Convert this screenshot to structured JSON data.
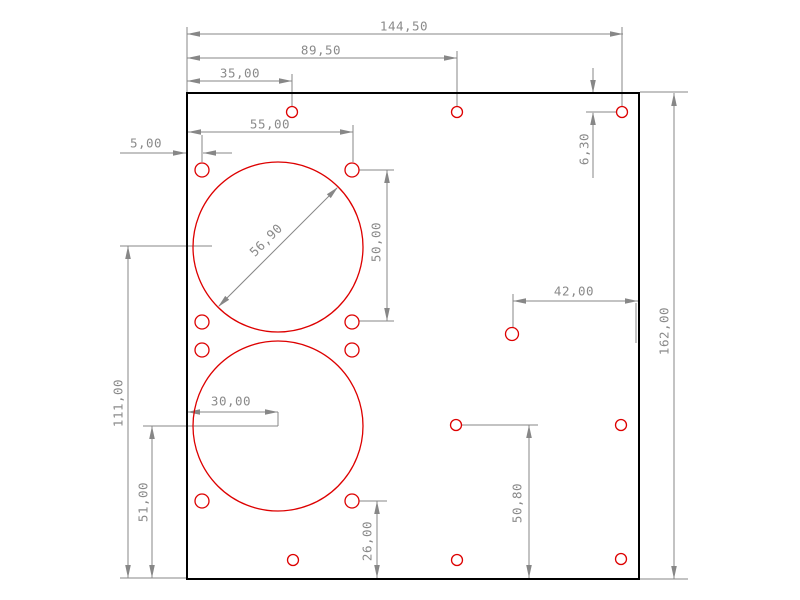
{
  "app": {
    "title": "CAD plate drawing"
  },
  "drawing": {
    "canvas": {
      "width": 800,
      "height": 600
    },
    "colors": {
      "background": "#ffffff",
      "outline": "#000000",
      "feature_red": "#dd0000",
      "dimension_line": "#878787",
      "dimension_text": "#8a8a8a"
    },
    "plate": {
      "x": 187,
      "y": 93,
      "width": 452,
      "height": 486
    },
    "cutouts": [
      {
        "cx": 278,
        "cy": 247,
        "r": 85
      },
      {
        "cx": 278,
        "cy": 426,
        "r": 85
      }
    ],
    "holes": [
      {
        "cx": 202,
        "cy": 170,
        "r": 7
      },
      {
        "cx": 352,
        "cy": 170,
        "r": 7
      },
      {
        "cx": 202,
        "cy": 322,
        "r": 7
      },
      {
        "cx": 352,
        "cy": 322,
        "r": 7
      },
      {
        "cx": 202,
        "cy": 350,
        "r": 7
      },
      {
        "cx": 352,
        "cy": 350,
        "r": 7
      },
      {
        "cx": 202,
        "cy": 501,
        "r": 7
      },
      {
        "cx": 352,
        "cy": 501,
        "r": 7
      },
      {
        "cx": 292,
        "cy": 112,
        "r": 5.5
      },
      {
        "cx": 457,
        "cy": 112,
        "r": 5.5
      },
      {
        "cx": 622,
        "cy": 112,
        "r": 5.5
      },
      {
        "cx": 512,
        "cy": 334,
        "r": 6.5
      },
      {
        "cx": 456,
        "cy": 425,
        "r": 5.5
      },
      {
        "cx": 621,
        "cy": 425,
        "r": 5.5
      },
      {
        "cx": 293,
        "cy": 560,
        "r": 5.5
      },
      {
        "cx": 457,
        "cy": 560,
        "r": 5.5
      },
      {
        "cx": 621,
        "cy": 559,
        "r": 5.5
      }
    ],
    "dimensions": [
      {
        "name": "dimension-144-50",
        "label": "144,50",
        "text": {
          "x": 404,
          "y": 26,
          "rot": 0
        },
        "lines": [
          [
            187,
            34,
            623,
            34
          ],
          [
            187,
            27,
            187,
            92
          ],
          [
            622,
            27,
            622,
            106
          ]
        ],
        "arrows": [
          {
            "tip": [
              187,
              34
            ],
            "dir": "left"
          },
          {
            "tip": [
              623,
              34
            ],
            "dir": "right"
          }
        ]
      },
      {
        "name": "dimension-89-50",
        "label": "89,50",
        "text": {
          "x": 321,
          "y": 50,
          "rot": 0
        },
        "lines": [
          [
            187,
            58,
            457,
            58
          ],
          [
            457,
            51,
            457,
            106
          ]
        ],
        "arrows": [
          {
            "tip": [
              187,
              58
            ],
            "dir": "left"
          },
          {
            "tip": [
              457,
              58
            ],
            "dir": "right"
          }
        ]
      },
      {
        "name": "dimension-35-00",
        "label": "35,00",
        "text": {
          "x": 240,
          "y": 73,
          "rot": 0
        },
        "lines": [
          [
            187,
            81,
            292,
            81
          ],
          [
            292,
            74,
            292,
            106
          ]
        ],
        "arrows": [
          {
            "tip": [
              187,
              81
            ],
            "dir": "left"
          },
          {
            "tip": [
              292,
              81
            ],
            "dir": "right"
          }
        ]
      },
      {
        "name": "dimension-55-00",
        "label": "55,00",
        "text": {
          "x": 270,
          "y": 124,
          "rot": 0
        },
        "lines": [
          [
            188,
            132,
            353,
            132
          ],
          [
            353,
            125,
            353,
            162
          ]
        ],
        "arrows": [
          {
            "tip": [
              188,
              132
            ],
            "dir": "left"
          },
          {
            "tip": [
              353,
              132
            ],
            "dir": "right"
          }
        ]
      },
      {
        "name": "dimension-5-00",
        "label": "5,00",
        "text": {
          "x": 146,
          "y": 143,
          "rot": 0
        },
        "lines": [
          [
            120,
            153,
            186,
            153
          ],
          [
            203,
            153,
            232,
            153
          ],
          [
            202,
            135,
            202,
            162
          ]
        ],
        "arrows": [
          {
            "tip": [
              186,
              153
            ],
            "dir": "right"
          },
          {
            "tip": [
              203,
              153
            ],
            "dir": "left"
          }
        ]
      },
      {
        "name": "dimension-6-30",
        "label": "6,30",
        "text": {
          "x": 584,
          "y": 149,
          "rot": -90
        },
        "lines": [
          [
            593,
            68,
            593,
            92
          ],
          [
            586,
            112,
            617,
            112
          ],
          [
            593,
            113,
            593,
            178
          ]
        ],
        "arrows": [
          {
            "tip": [
              593,
              93
            ],
            "dir": "down"
          },
          {
            "tip": [
              593,
              112
            ],
            "dir": "up"
          }
        ]
      },
      {
        "name": "dimension-50-00",
        "label": "50,00",
        "text": {
          "x": 376,
          "y": 242,
          "rot": -90
        },
        "lines": [
          [
            387,
            170,
            387,
            321
          ],
          [
            359,
            170,
            394,
            170
          ],
          [
            359,
            321,
            394,
            321
          ]
        ],
        "arrows": [
          {
            "tip": [
              387,
              170
            ],
            "dir": "up"
          },
          {
            "tip": [
              387,
              321
            ],
            "dir": "down"
          }
        ]
      },
      {
        "name": "dimension-42-00",
        "label": "42,00",
        "text": {
          "x": 574,
          "y": 291,
          "rot": 0
        },
        "lines": [
          [
            513,
            301,
            638,
            301
          ],
          [
            513,
            294,
            513,
            328
          ],
          [
            636,
            303,
            636,
            343
          ]
        ],
        "arrows": [
          {
            "tip": [
              513,
              301
            ],
            "dir": "left"
          },
          {
            "tip": [
              638,
              301
            ],
            "dir": "right"
          }
        ]
      },
      {
        "name": "dimension-162-00",
        "label": "162,00",
        "text": {
          "x": 664,
          "y": 331,
          "rot": -90
        },
        "lines": [
          [
            674,
            93,
            674,
            579
          ],
          [
            640,
            92,
            688,
            92
          ],
          [
            640,
            579,
            688,
            579
          ]
        ],
        "arrows": [
          {
            "tip": [
              674,
              93
            ],
            "dir": "up"
          },
          {
            "tip": [
              674,
              579
            ],
            "dir": "down"
          }
        ]
      },
      {
        "name": "dimension-56-90-diameter",
        "label": "56,90",
        "text": {
          "x": 266,
          "y": 240,
          "rot": -45
        },
        "lines": [
          [
            219,
            306,
            337,
            188
          ]
        ],
        "arrows": [
          {
            "tip": [
              218,
              307
            ],
            "dir": "sw"
          },
          {
            "tip": [
              338,
              187
            ],
            "dir": "ne"
          }
        ]
      },
      {
        "name": "dimension-30-00",
        "label": "30,00",
        "text": {
          "x": 231,
          "y": 401,
          "rot": 0
        },
        "lines": [
          [
            187,
            412,
            278,
            412
          ],
          [
            278,
            412,
            278,
            426
          ]
        ],
        "arrows": [
          {
            "tip": [
              187,
              412
            ],
            "dir": "left"
          },
          {
            "tip": [
              278,
              412
            ],
            "dir": "right"
          }
        ]
      },
      {
        "name": "dimension-111-00",
        "label": "111,00",
        "text": {
          "x": 118,
          "y": 403,
          "rot": -90
        },
        "lines": [
          [
            128,
            246,
            128,
            578
          ],
          [
            120,
            246,
            212,
            246
          ],
          [
            120,
            578,
            187,
            578
          ]
        ],
        "arrows": [
          {
            "tip": [
              128,
              246
            ],
            "dir": "up"
          },
          {
            "tip": [
              128,
              578
            ],
            "dir": "down"
          }
        ]
      },
      {
        "name": "dimension-51-00",
        "label": "51,00",
        "text": {
          "x": 143,
          "y": 502,
          "rot": -90
        },
        "lines": [
          [
            152,
            426,
            152,
            578
          ],
          [
            143,
            426,
            278,
            426
          ]
        ],
        "arrows": [
          {
            "tip": [
              152,
              426
            ],
            "dir": "up"
          },
          {
            "tip": [
              152,
              578
            ],
            "dir": "down"
          }
        ]
      },
      {
        "name": "dimension-26-00",
        "label": "26,00",
        "text": {
          "x": 367,
          "y": 541,
          "rot": -90
        },
        "lines": [
          [
            377,
            501,
            377,
            578
          ],
          [
            359,
            501,
            387,
            501
          ]
        ],
        "arrows": [
          {
            "tip": [
              377,
              501
            ],
            "dir": "up"
          },
          {
            "tip": [
              377,
              578
            ],
            "dir": "down"
          }
        ]
      },
      {
        "name": "dimension-50-80",
        "label": "50,80",
        "text": {
          "x": 517,
          "y": 503,
          "rot": -90
        },
        "lines": [
          [
            529,
            425,
            529,
            578
          ],
          [
            462,
            425,
            538,
            425
          ]
        ],
        "arrows": [
          {
            "tip": [
              529,
              425
            ],
            "dir": "up"
          },
          {
            "tip": [
              529,
              578
            ],
            "dir": "down"
          }
        ]
      }
    ]
  }
}
